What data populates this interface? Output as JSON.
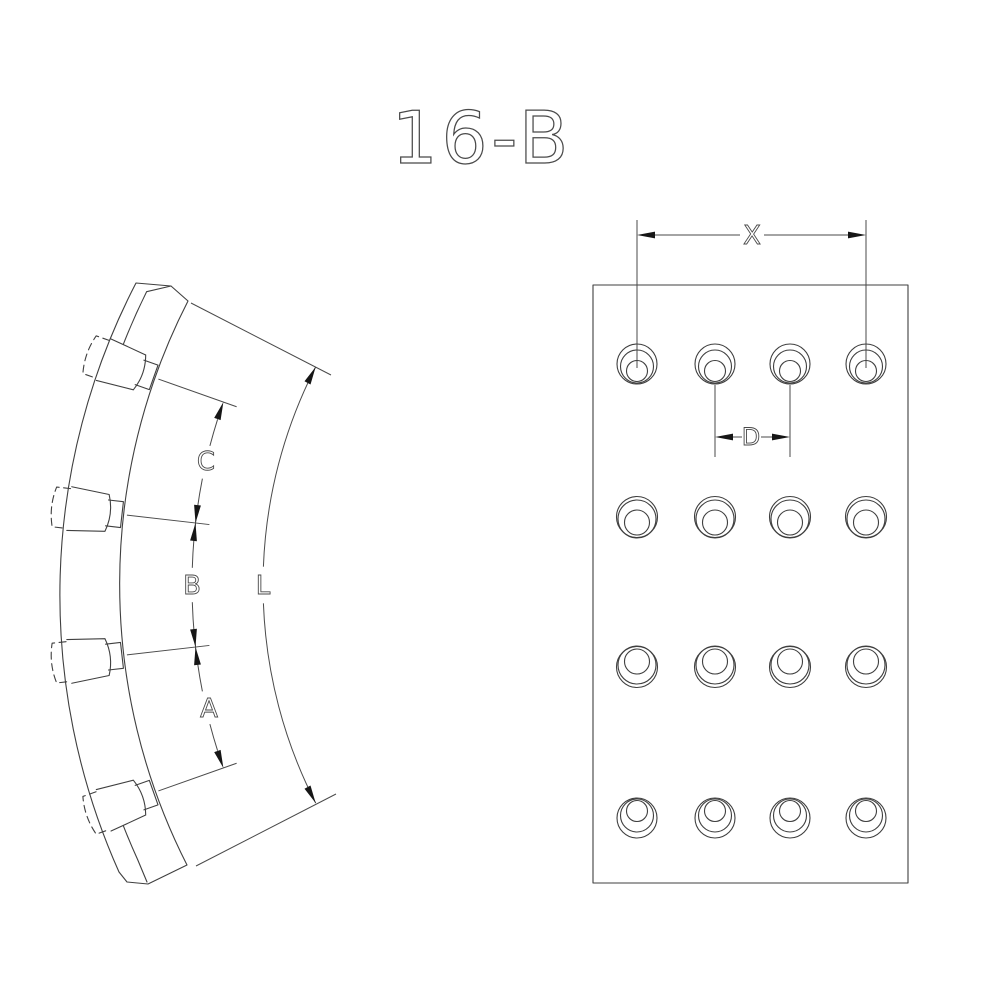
{
  "title": "16-B",
  "drawing": {
    "background": "#ffffff",
    "line_color": "#3f3f3f",
    "arrow_color": "#161616",
    "type": "technical drawing, brake lining segment, two views"
  },
  "left_view": {
    "description": "curved side-profile view with four counterbored holes and chain dimensions",
    "dim_labels": {
      "A": "A",
      "B": "B",
      "C": "C",
      "L": "L"
    }
  },
  "right_view": {
    "description": "flat hole-pattern view, 4 columns x 4 rows of counterbored holes",
    "dim_labels": {
      "X": "X",
      "D": "D"
    },
    "plate": {
      "x": 593,
      "y": 285,
      "width": 315,
      "height": 598
    },
    "holes": {
      "cols_x": [
        637,
        715,
        790,
        866
      ],
      "rows": [
        {
          "y": 364,
          "circles": [
            {
              "r": 20,
              "dy": 0
            },
            {
              "r": 16.5,
              "dy": 2.5
            },
            {
              "r": 10.5,
              "dy": 7
            }
          ]
        },
        {
          "y": 517,
          "circles": [
            {
              "r": 20.5,
              "dy": 0
            },
            {
              "r": 19,
              "dy": 2
            },
            {
              "r": 12.5,
              "dy": 5.5
            }
          ]
        },
        {
          "y": 667,
          "circles": [
            {
              "r": 20.5,
              "dy": 0
            },
            {
              "r": 19,
              "dy": -2
            },
            {
              "r": 12.5,
              "dy": -5.5
            }
          ]
        },
        {
          "y": 818,
          "circles": [
            {
              "r": 20,
              "dy": 0
            },
            {
              "r": 16.5,
              "dy": -2.5
            },
            {
              "r": 10.5,
              "dy": -7
            }
          ]
        }
      ]
    }
  }
}
